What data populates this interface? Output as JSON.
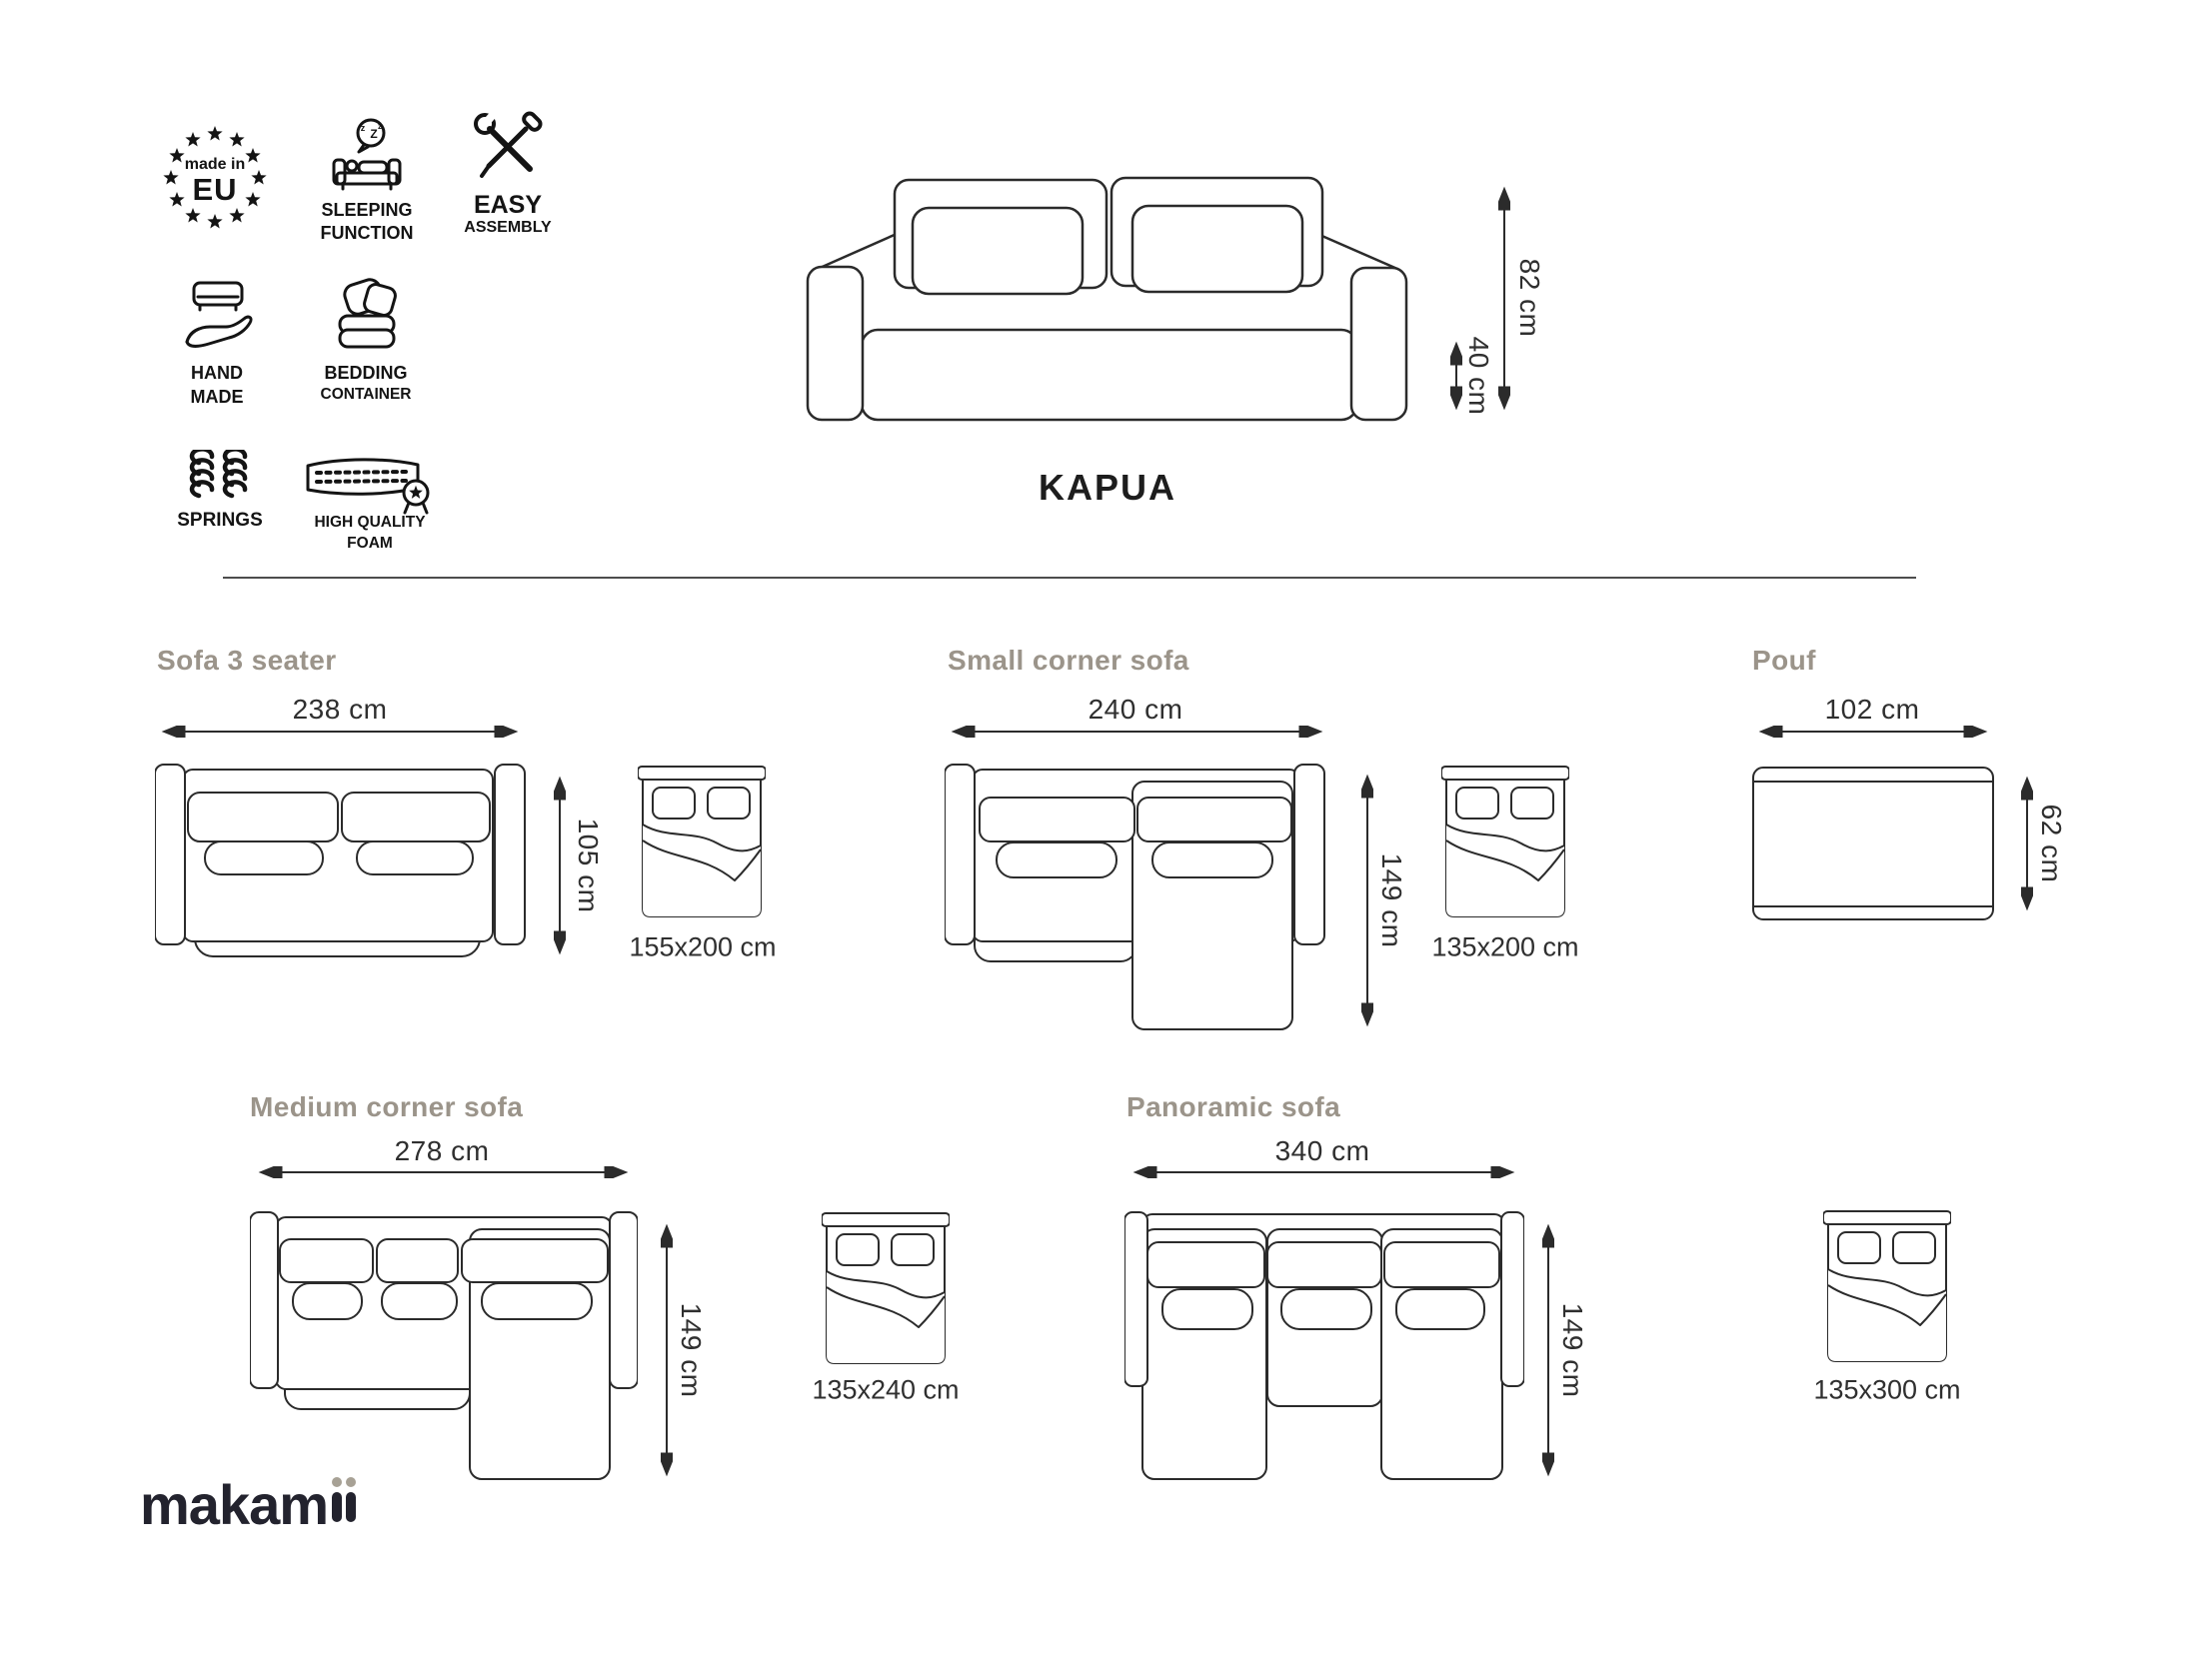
{
  "product": {
    "name": "KAPUA"
  },
  "badges": {
    "made_in_eu": {
      "line1": "made in",
      "line2": "EU"
    },
    "sleeping": {
      "line1": "SLEEPING",
      "line2": "FUNCTION",
      "z1": "z",
      "z2": "Z",
      "z3": "z"
    },
    "easy": {
      "line1": "EASY",
      "line2": "ASSEMBLY"
    },
    "handmade": {
      "line1": "HAND",
      "line2": "MADE"
    },
    "bedding": {
      "line1": "BEDDING",
      "line2": "CONTAINER"
    },
    "springs": {
      "label": "SPRINGS"
    },
    "foam": {
      "line1": "HIGH QUALITY",
      "line2": "FOAM"
    }
  },
  "front_view": {
    "height": "82 cm",
    "seat_height": "40 cm"
  },
  "variants": {
    "sofa3": {
      "title": "Sofa 3 seater",
      "width": "238 cm",
      "depth": "105 cm",
      "bed": "155x200 cm"
    },
    "small_corner": {
      "title": "Small corner sofa",
      "width": "240 cm",
      "depth": "149 cm",
      "bed": "135x200 cm"
    },
    "pouf": {
      "title": "Pouf",
      "width": "102 cm",
      "depth": "62 cm"
    },
    "medium_corner": {
      "title": "Medium corner sofa",
      "width": "278 cm",
      "depth": "149 cm",
      "bed": "135x240 cm"
    },
    "panoramic": {
      "title": "Panoramic sofa",
      "width": "340 cm",
      "depth": "149 cm",
      "bed": "135x300 cm"
    }
  },
  "logo": {
    "main": "makam",
    "suffix": "ii",
    "full": "makamii"
  },
  "colors": {
    "line": "#2b2b2b",
    "heading": "#9b948a",
    "text": "#2f2f2f",
    "logo": "#23232e",
    "logo_accent": "#a7a195"
  }
}
